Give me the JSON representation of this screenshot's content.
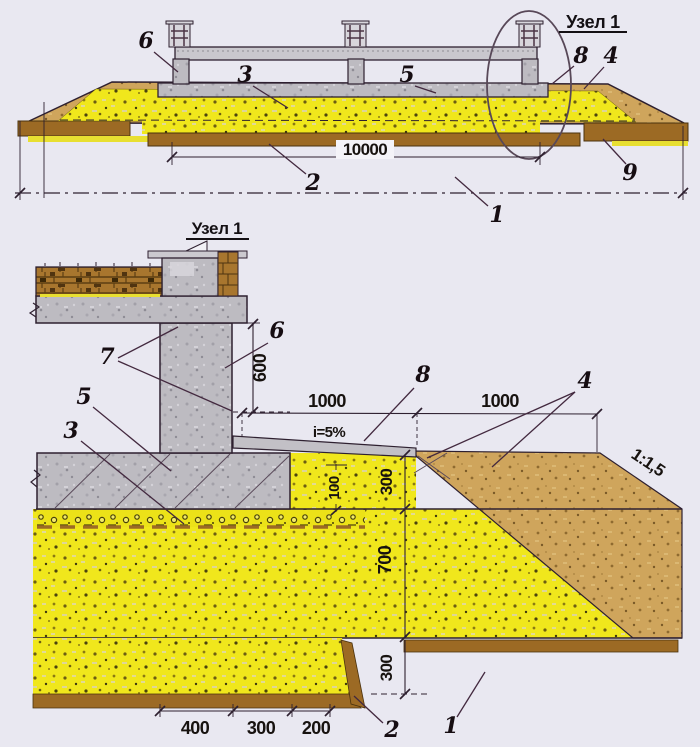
{
  "colors": {
    "background": "#e9e8f1",
    "sand_fill": "#f0e71c",
    "soil_fill": "#cfa55c",
    "topsoil_fill": "#9c6a24",
    "concrete_fill": "#bdbbc1",
    "outline": "#2e2030"
  },
  "overview": {
    "detail_callout_label": "Узел 1",
    "dim_width": "10000",
    "callouts": {
      "c6": "6",
      "c3": "3",
      "c5": "5",
      "c8": "8",
      "c4": "4",
      "c9": "9",
      "c2": "2",
      "c1": "1"
    }
  },
  "detail": {
    "title": "Узел 1",
    "callouts": {
      "c7": "7",
      "c5": "5",
      "c3": "3",
      "c6": "6",
      "c8": "8",
      "c4": "4",
      "c2": "2",
      "c1": "1"
    },
    "dims": {
      "plinth_height": "600",
      "apron_width": "1000",
      "apron_slope": "i=5%",
      "backfill_width": "1000",
      "embankment_slope": "1:1,5",
      "bed_100": "100",
      "cushion_above": "300",
      "cushion_below": "700",
      "base_step": "300",
      "b400": "400",
      "b300": "300",
      "b200": "200"
    }
  }
}
